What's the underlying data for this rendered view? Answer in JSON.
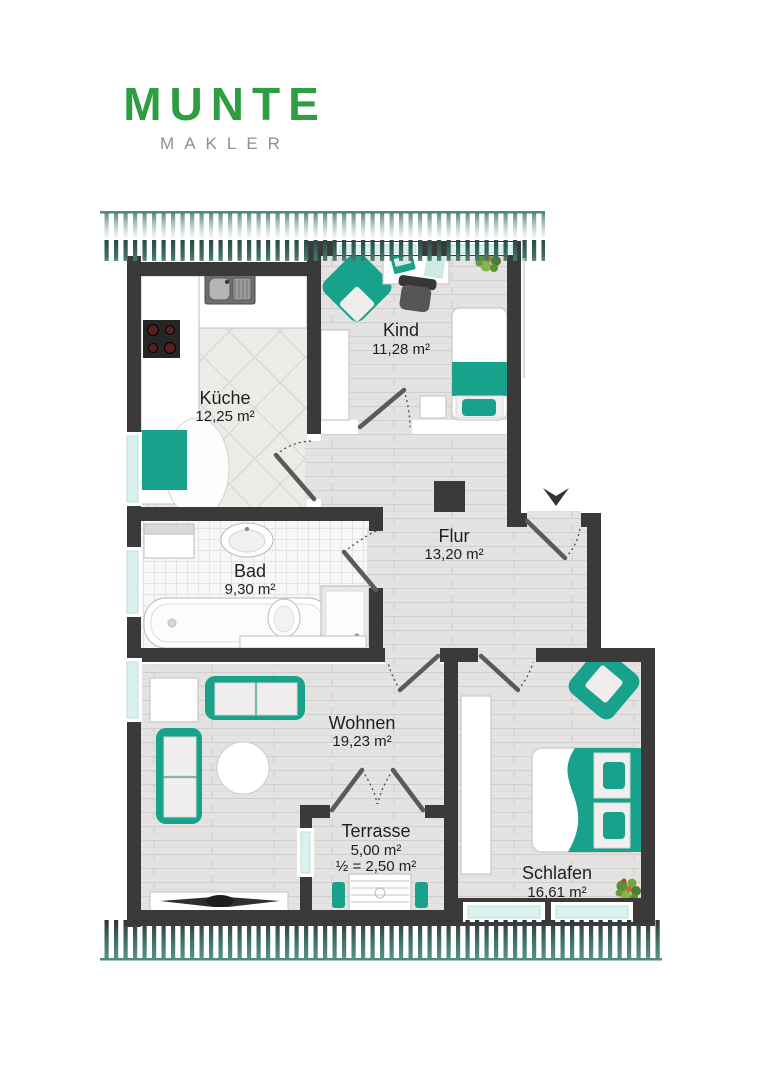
{
  "brand": {
    "name": "MUNTE",
    "subtitle": "MAKLER"
  },
  "palette": {
    "brand_green": "#2f9d42",
    "subtitle_gray": "#8f8f8f",
    "furniture_teal": "#18a28b",
    "wall_dark": "#3a3a3a",
    "window_cyan": "#d9f2f0",
    "hatch_teal": "#4e8c80",
    "floor_light": "#e4e3e1",
    "label_text": "#1f1f1f"
  },
  "floorplan": {
    "rooms": {
      "kueche": {
        "name": "Küche",
        "area": "12,25 m²"
      },
      "kind": {
        "name": "Kind",
        "area": "11,28 m²"
      },
      "bad": {
        "name": "Bad",
        "area": "9,30 m²"
      },
      "flur": {
        "name": "Flur",
        "area": "13,20 m²"
      },
      "wohnen": {
        "name": "Wohnen",
        "area": "19,23 m²"
      },
      "terrasse": {
        "name": "Terrasse",
        "area": "5,00 m²",
        "area_half": "½ = 2,50 m²"
      },
      "schlafen": {
        "name": "Schlafen",
        "area": "16,61 m²"
      }
    },
    "icons": {
      "entrance_arrow": "triangle-down"
    }
  }
}
